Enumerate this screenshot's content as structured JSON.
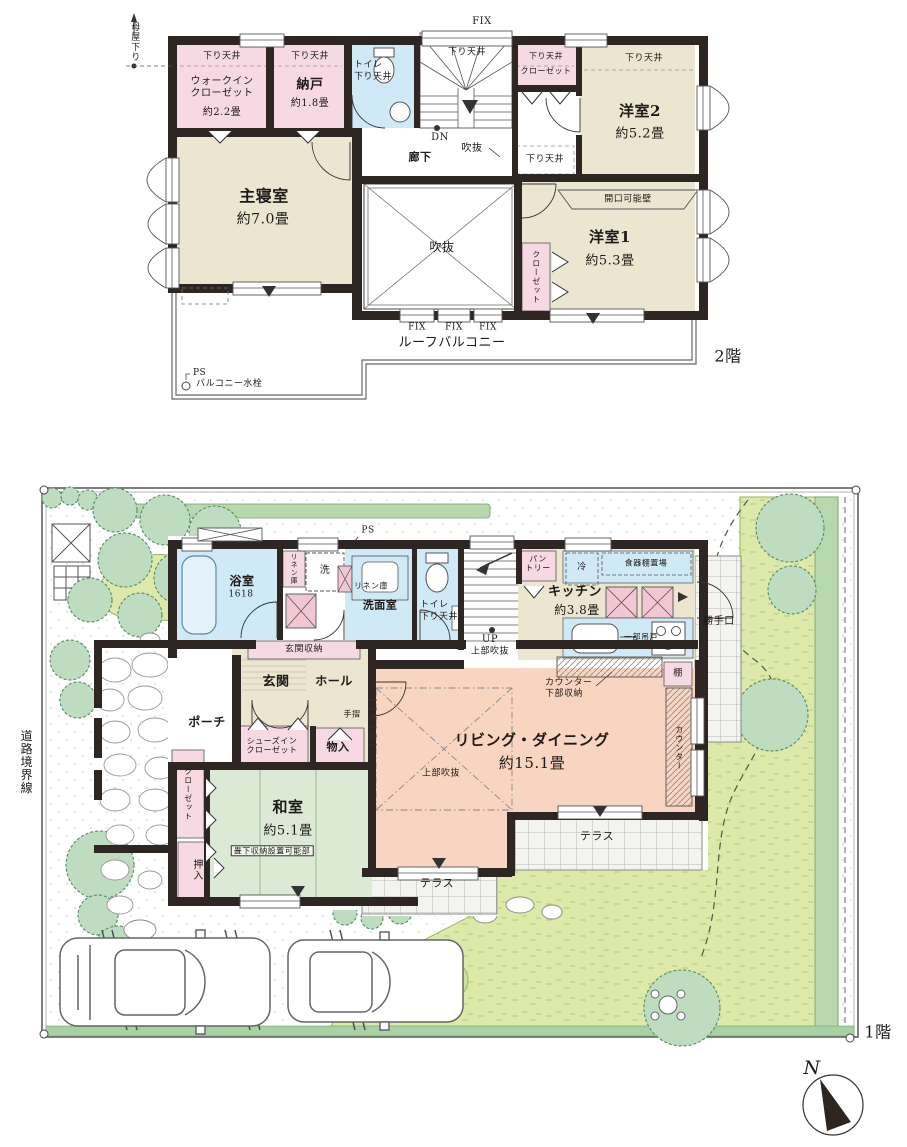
{
  "palette": {
    "wall": "#2e2622",
    "bedroom_floor": "#ece5d0",
    "closet_pink": "#f7d9e3",
    "wet_blue": "#cfe9f6",
    "tatami_green": "#dcead5",
    "living_peach": "#f8d5c1",
    "lawn": "#dce9a9",
    "tree_green": "#bddcc0",
    "accent_x_pink": "#f2c6d3"
  },
  "f2": {
    "floor_label": "2階",
    "moya": "母屋下り",
    "wic": {
      "ceiling": "下り天井",
      "name": "ウォークイン\nクローゼット",
      "size": "約2.2畳"
    },
    "nando": {
      "ceiling": "下り天井",
      "name": "納戸",
      "size": "約1.8畳"
    },
    "toilet": {
      "name": "トイレ",
      "ceiling": "下り天井"
    },
    "stairs": {
      "fix": "FIX",
      "ceiling": "下り天井",
      "dn": "DN"
    },
    "void_small": "吹抜",
    "corridor": "廊下",
    "closet_n": {
      "ceiling": "下り天井",
      "name": "クローゼット"
    },
    "yo2": {
      "ceiling": "下り天井",
      "name": "洋室2",
      "size": "約5.2畳"
    },
    "ceiling_mid": "下り天井",
    "master": {
      "name": "主寝室",
      "size": "約7.0畳"
    },
    "void_big": "吹抜",
    "yo1": {
      "wall": "開口可能壁",
      "name": "洋室1",
      "size": "約5.3畳",
      "closet": "クローゼット"
    },
    "balcony": {
      "fix": [
        "FIX",
        "FIX",
        "FIX"
      ],
      "name": "ルーフバルコニー",
      "ps": "PS",
      "faucet": "バルコニー水栓"
    }
  },
  "f1": {
    "floor_label": "1階",
    "road": "道路境界線",
    "bath": {
      "name": "浴室",
      "size": "1618"
    },
    "linen_a": "リネン庫",
    "washer": "洗",
    "linen_b": "リネン庫",
    "senmen": "洗面室",
    "ps": "PS",
    "toilet": {
      "name": "トイレ",
      "ceiling": "下り天井"
    },
    "stairs": {
      "up": "UP",
      "void": "上部吹抜"
    },
    "pantry": "パン\nトリー",
    "kitchen": {
      "fridge": "冷",
      "cupboard": "食器棚置場",
      "name": "キッチン",
      "size": "約3.8畳",
      "hanging": "一部吊戸",
      "backdoor": "勝手口"
    },
    "shelf": "棚",
    "counter_storage": "カウンター\n下部収納",
    "counter": "カウンター",
    "genkan_storage": "玄関収納",
    "genkan": "玄関",
    "hall": "ホール",
    "handrail": "手摺",
    "sic": "シューズイン\nクローゼット",
    "monoire": "物入",
    "porch": "ポーチ",
    "closet": "クローゼット",
    "oshiire": "押入",
    "washitsu": {
      "name": "和室",
      "size": "約5.1畳",
      "note": "畳下収納設置可能部"
    },
    "living": {
      "name": "リビング・ダイニング",
      "size": "約15.1畳",
      "void": "上部吹抜"
    },
    "terrace_a": "テラス",
    "terrace_b": "テラス"
  },
  "compass": {
    "north": "N"
  }
}
